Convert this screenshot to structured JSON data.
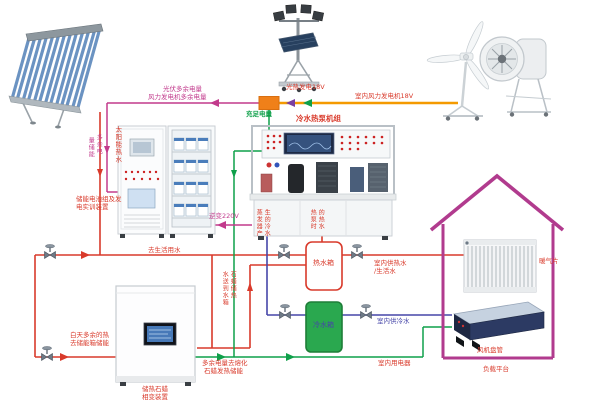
{
  "colors": {
    "pipe_hot": "#d93a2b",
    "pipe_cold": "#4646a8",
    "wire_green": "#0fa04a",
    "wire_magenta": "#c23a8c",
    "bus_orange": "#f49a00",
    "house_outline": "#b13b8e",
    "junction_box": "#f08019",
    "cold_tank_fill": "#2aa84f"
  },
  "power": {
    "pv_surplus": "光伏多余电量",
    "wind_surplus": "风力发电机多余电量",
    "charged": "充足电量",
    "solar_thermal_gen": "光热发电18V",
    "indoor_wind_gen": "室内风力发电机18V",
    "inverter": "逆变220V",
    "surplus_storage_col_right": "多余电",
    "surplus_storage_col_left": "量储能",
    "melt_line1": "多余电量去熔化",
    "melt_line2": "石蜡发热储能",
    "indoor_appliances": "室内用电器"
  },
  "equipment": {
    "battery_line1": "储能电池组及发",
    "battery_line2": "电实训装置",
    "heat_pump_title": "冷水热泵机组",
    "paraffin_line1": "储热石蜡",
    "paraffin_line2": "相变装置",
    "hot_tank": "热水箱",
    "cold_tank": "冷水箱",
    "radiator": "暖气片",
    "fan_coil": "风机盘管",
    "load_platform": "负载平台"
  },
  "water": {
    "solar_hot": "太阳能热水",
    "domestic": "去生活用水",
    "day_surplus_line1": "白天多余的热",
    "day_surplus_line2": "去储能箱储能",
    "paraffin_to_tank_col_right": "石蜡储热",
    "paraffin_to_tank_col_left": "水送到水箱",
    "evaporator_col_left": "蒸发器产",
    "evaporator_col_right": "生的冷水",
    "heatpump_hot_col_left": "热泵时",
    "heatpump_hot_col_right": "的热水",
    "indoor_hot_line1": "室内供热水",
    "indoor_hot_line2": "/生活水",
    "indoor_cold": "室内供冷水"
  }
}
